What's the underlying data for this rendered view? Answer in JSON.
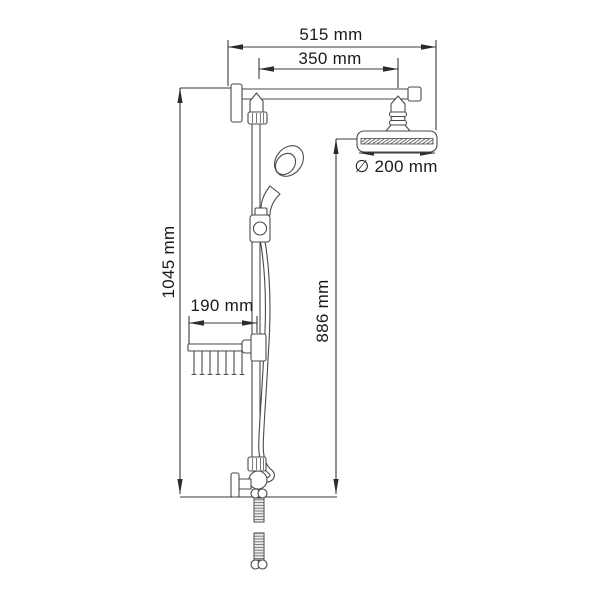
{
  "drawing": {
    "background": "#ffffff",
    "line_color": "#4a4a4a",
    "dimension_line_color": "#3a3a3a",
    "label_color": "#1b1b1b",
    "labels": {
      "total_width": "515 mm",
      "arm_span": "350 mm",
      "head_diameter": "∅ 200 mm",
      "total_height": "1045 mm",
      "drop_height": "886 mm",
      "basket_width": "190 mm"
    }
  }
}
